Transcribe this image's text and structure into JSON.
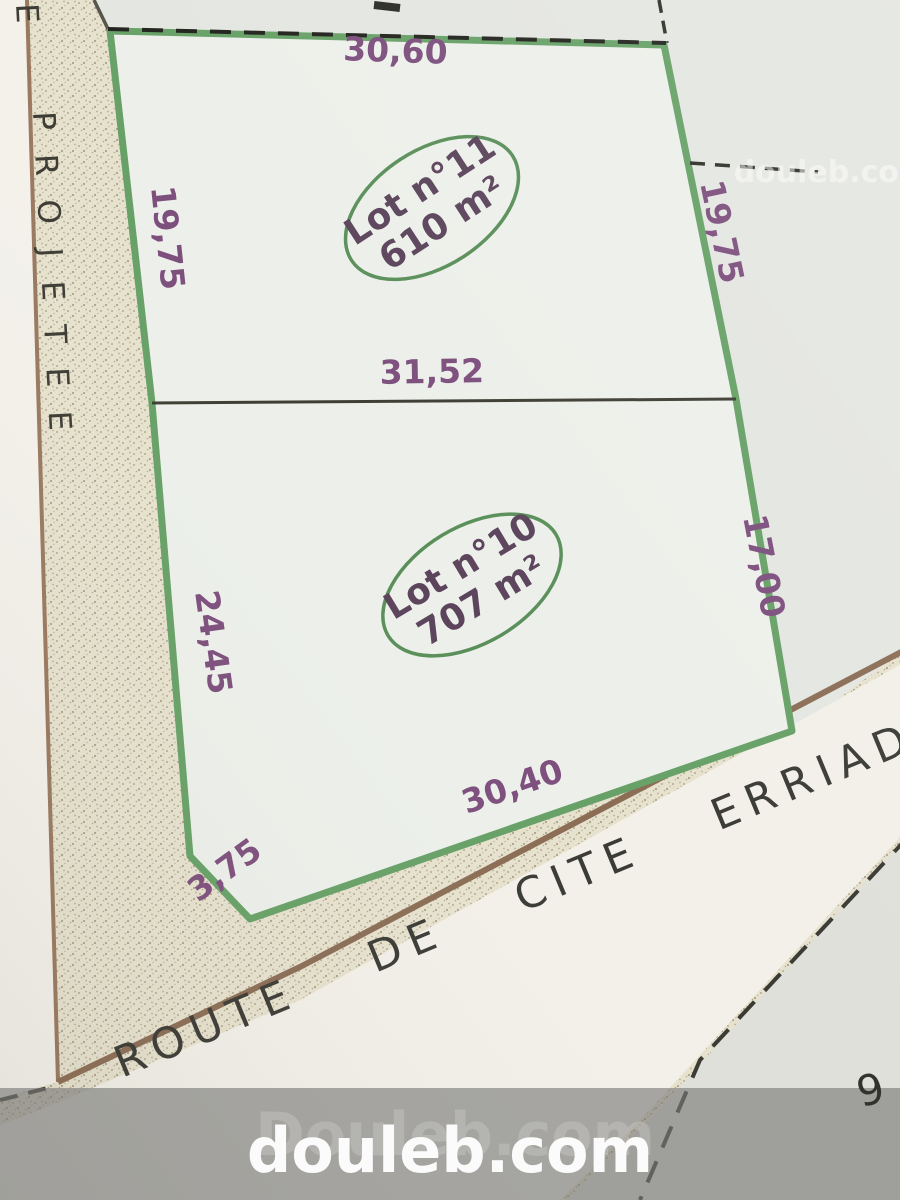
{
  "plan": {
    "lots": [
      {
        "label": "Lot n°11",
        "area": "610 m²"
      },
      {
        "label": "Lot n°10",
        "area": "707 m²"
      }
    ],
    "dimensions": {
      "top": "30,60",
      "upper_left": "19,75",
      "upper_right": "19,75",
      "middle": "31,52",
      "lower_left": "24,45",
      "lower_right": "17,00",
      "bottom": "30,40",
      "corner_cut": "3,75"
    },
    "roads": {
      "left_street": "PROJETEE",
      "left_street_partial": "E",
      "bottom_road": "ROUTE DE CITE ERRIADH"
    },
    "parcel_ref": "9"
  },
  "watermarks": {
    "corner": "douleb.com",
    "banner_ghost": "Douleb.com",
    "banner_main": "douleb.com"
  },
  "colors": {
    "lot_border_green": "#67a167",
    "dimension_purple": "#7d4f7d",
    "stamp_purple": "#5c455c",
    "road_brown": "#8b6d55",
    "paper_beige": "#e7e2ce",
    "banner_gray": "rgba(120,120,118,0.62)"
  }
}
